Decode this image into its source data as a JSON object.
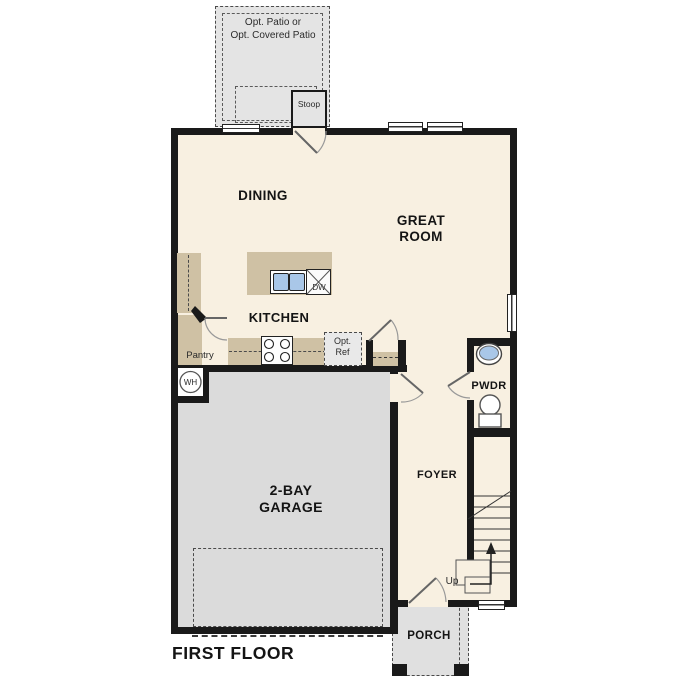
{
  "title": "FIRST FLOOR",
  "colors": {
    "interior": "#f8f0e1",
    "cabinet_tan": "#cfc1a4",
    "garage_gray": "#dbdbdb",
    "patio_gray": "#e4e4e4",
    "porch_gray": "#e0e0e0",
    "wall_black": "#1a1a1a",
    "sink_blue": "#a9c7e8"
  },
  "rooms": {
    "dining": "DINING",
    "great_room": "GREAT ROOM",
    "kitchen": "KITCHEN",
    "garage": "2-BAY GARAGE",
    "foyer": "FOYER",
    "powder": "PWDR",
    "porch": "PORCH"
  },
  "labels": {
    "patio_line1": "Opt. Patio or",
    "patio_line2": "Opt. Covered Patio",
    "stoop": "Stoop",
    "pantry": "Pantry",
    "opt_ref": "Opt. Ref",
    "dishwasher": "DW",
    "water_heater": "WH",
    "stairs_up": "Up",
    "floor_title": "FIRST FLOOR"
  }
}
